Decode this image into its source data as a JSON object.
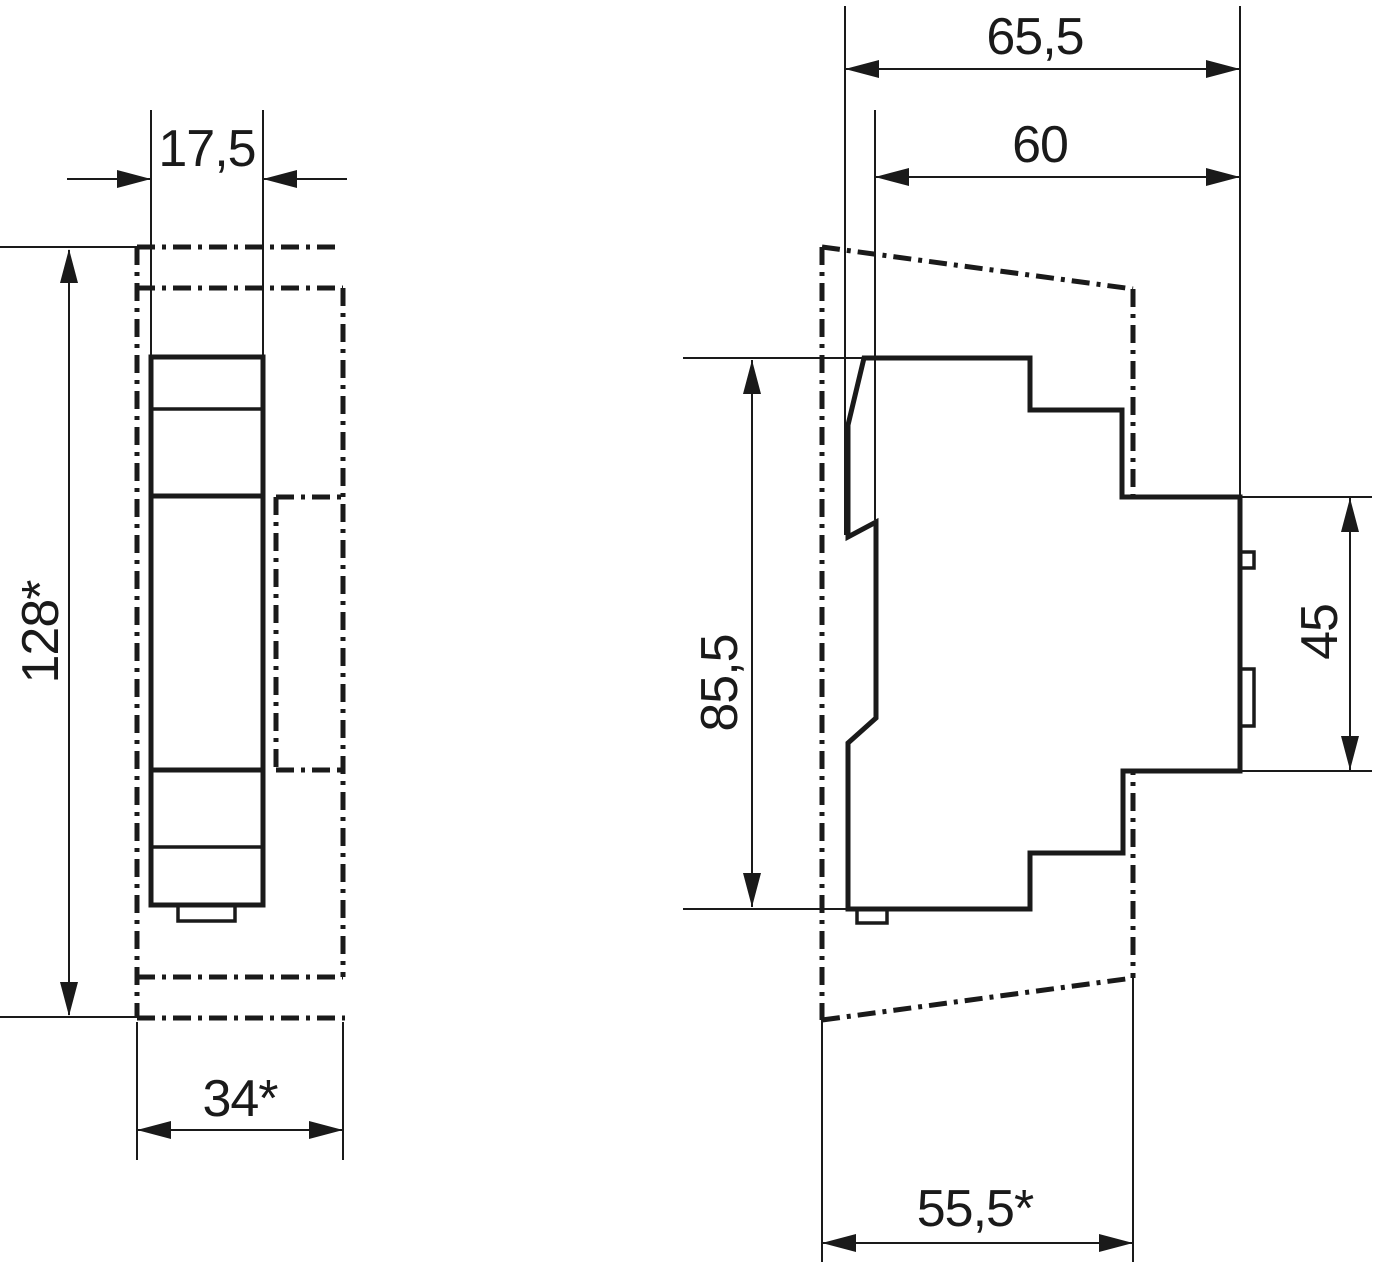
{
  "drawing": {
    "type": "technical dimensional drawing, DIN-rail device, two views",
    "background": "#ffffff",
    "line_color": "#1a1a1a",
    "views": [
      {
        "id": "front",
        "description": "front view of 1-module DIN device with panel cutout shown dash-dotted"
      },
      {
        "id": "side",
        "description": "side profile view with panel contour shown dash-dotted"
      }
    ],
    "dimensions": {
      "front_width": "17,5",
      "front_height": "128*",
      "front_cutout_width": "34*",
      "side_depth_total": "65,5",
      "side_depth_body": "60",
      "side_height": "85,5",
      "side_rear_height": "45",
      "side_panel_depth": "55,5*"
    }
  }
}
